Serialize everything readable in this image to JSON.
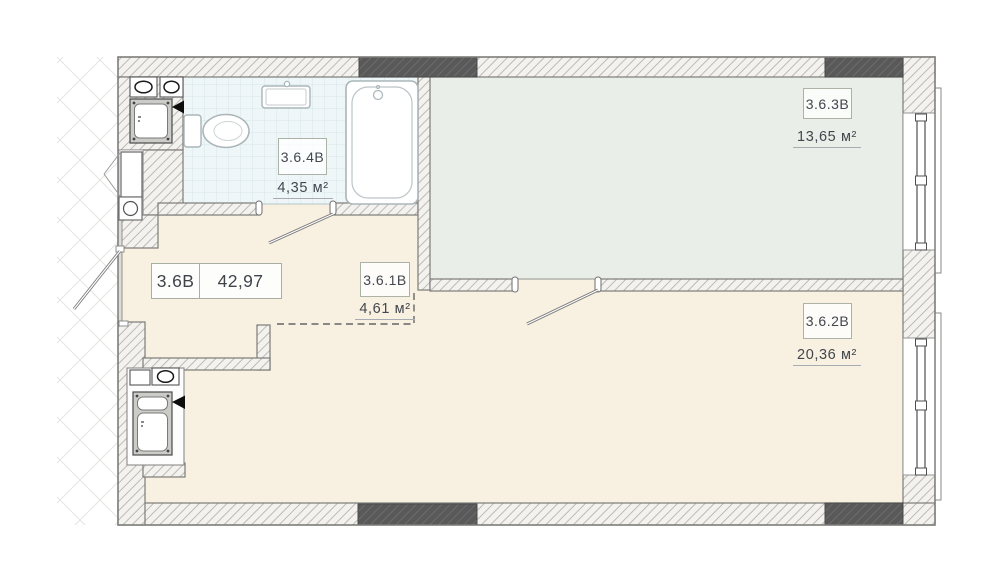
{
  "plan": {
    "labels": {
      "total": {
        "code": "3.6B",
        "area": "42,97"
      },
      "hallway": {
        "code": "3.6.1B",
        "area": "4,61 м²"
      },
      "living": {
        "code": "3.6.2B",
        "area": "20,36 м²"
      },
      "bedroom": {
        "code": "3.6.3B",
        "area": "13,65 м²"
      },
      "bathroom": {
        "code": "3.6.4B",
        "area": "4,35 м²"
      }
    },
    "colors": {
      "floor_beige": "#f8f0e1",
      "floor_green": "#e9efe8",
      "floor_tile": "#eef6f8",
      "tile_line": "#d7e7ea",
      "wall_bg": "#f4f2ee",
      "wall_line": "#bcbab4",
      "wall_dark": "#595959",
      "wall_dark_line": "#6c6c6c",
      "outline": "#7c7c78",
      "fixture_stroke": "#aab5b9",
      "text_color": "#42474e"
    }
  }
}
